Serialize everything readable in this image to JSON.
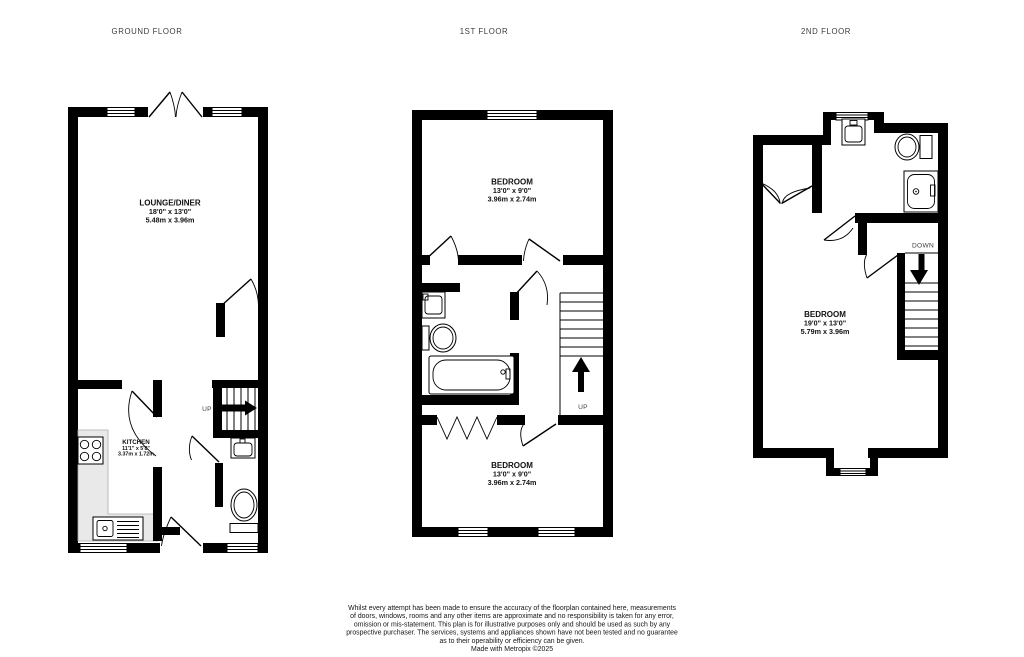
{
  "colors": {
    "wall": "#000000",
    "counter": "#e9e9e9",
    "text_dark": "#111111",
    "text_muted": "#3d3d3d"
  },
  "floors": [
    {
      "title": "GROUND FLOOR",
      "stair_direction": "UP",
      "rooms": [
        {
          "name": "LOUNGE/DINER",
          "imperial": "18'0\" x 13'0\"",
          "metric": "5.48m x 3.96m"
        },
        {
          "name": "KITCHEN",
          "imperial": "11'1\" x 5'8\"",
          "metric": "3.37m x 1.72m"
        }
      ],
      "fixtures": [
        "french-doors",
        "hob",
        "counter",
        "sink",
        "basin",
        "toilet",
        "stairs"
      ]
    },
    {
      "title": "1ST FLOOR",
      "stair_direction": "UP",
      "rooms": [
        {
          "name": "BEDROOM",
          "imperial": "13'0\" x 9'0\"",
          "metric": "3.96m x 2.74m"
        },
        {
          "name": "BEDROOM",
          "imperial": "13'0\" x 9'0\"",
          "metric": "3.96m x 2.74m"
        }
      ],
      "fixtures": [
        "basin",
        "toilet",
        "bathtub",
        "stairs",
        "bifold-doors"
      ]
    },
    {
      "title": "2ND FLOOR",
      "stair_direction": "DOWN",
      "rooms": [
        {
          "name": "BEDROOM",
          "imperial": "19'0\" x 13'0\"",
          "metric": "5.79m x 3.96m"
        }
      ],
      "fixtures": [
        "basin",
        "toilet",
        "shower",
        "stairs",
        "wardrobe-doors"
      ]
    }
  ],
  "disclaimer": {
    "lines": [
      "Whilst every attempt has been made to ensure the accuracy of the floorplan contained here, measurements",
      "of doors, windows, rooms and any other items are approximate and no responsibility is taken for any error,",
      "omission or mis-statement. This plan is for illustrative purposes only and should be used as such by any",
      "prospective purchaser. The services, systems and appliances shown have not been tested and no guarantee",
      "as to their operability or efficiency can be given."
    ],
    "credit": "Made with Metropix ©2025"
  }
}
